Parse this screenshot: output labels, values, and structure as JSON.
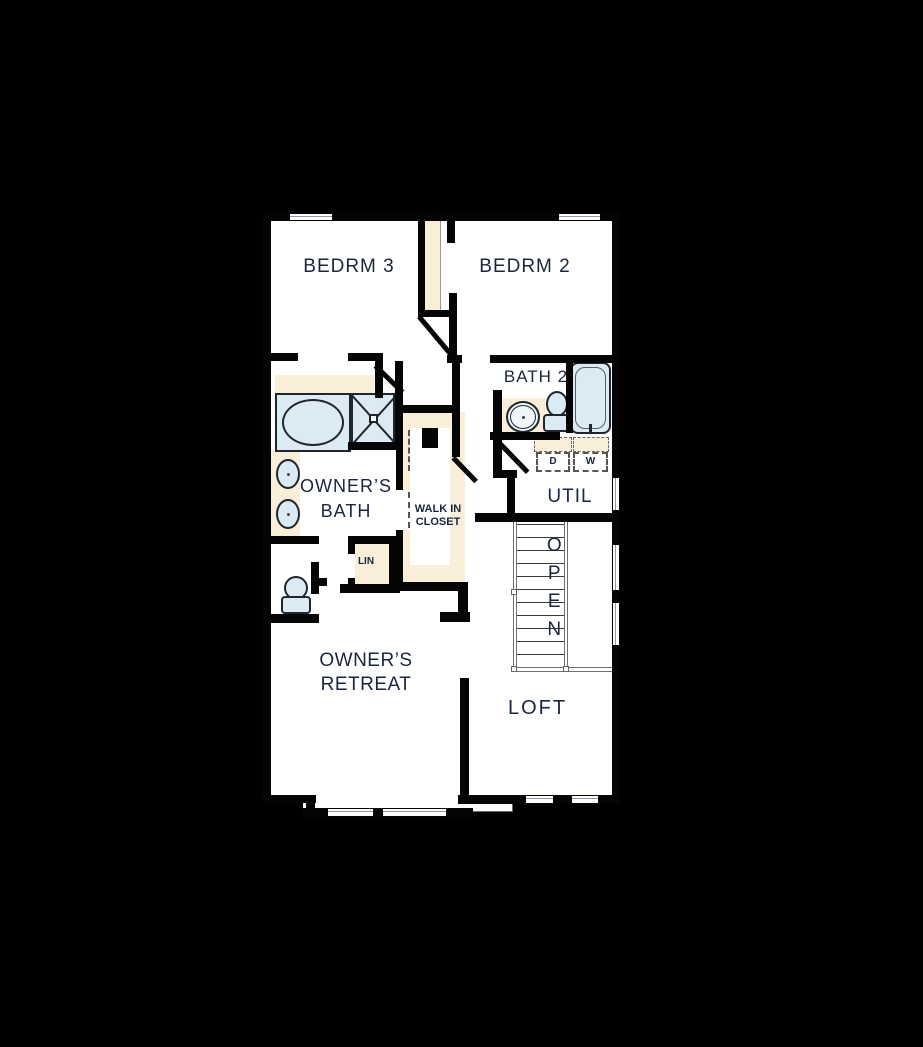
{
  "page": {
    "background": "#000000",
    "type": "second-floor plan"
  },
  "plan": {
    "rooms": {
      "bedrm3": "BEDRM 3",
      "bedrm2": "BEDRM 2",
      "bath2": "BATH 2",
      "util": "UTIL",
      "owners_bath": "OWNER’S\nBATH",
      "walk_in_closet": "WALK IN\nCLOSET",
      "linen": "LIN",
      "stairs_open": "OPEN",
      "owners_retreat": "OWNER’S RETREAT",
      "loft": "LOFT"
    },
    "appliances": {
      "dryer": "D",
      "washer": "W"
    },
    "colors": {
      "wall": "#050505",
      "floor": "#ffffff",
      "casework": "#f9eed8",
      "fixture": "#dcebf3",
      "label": "#1b2540"
    }
  }
}
